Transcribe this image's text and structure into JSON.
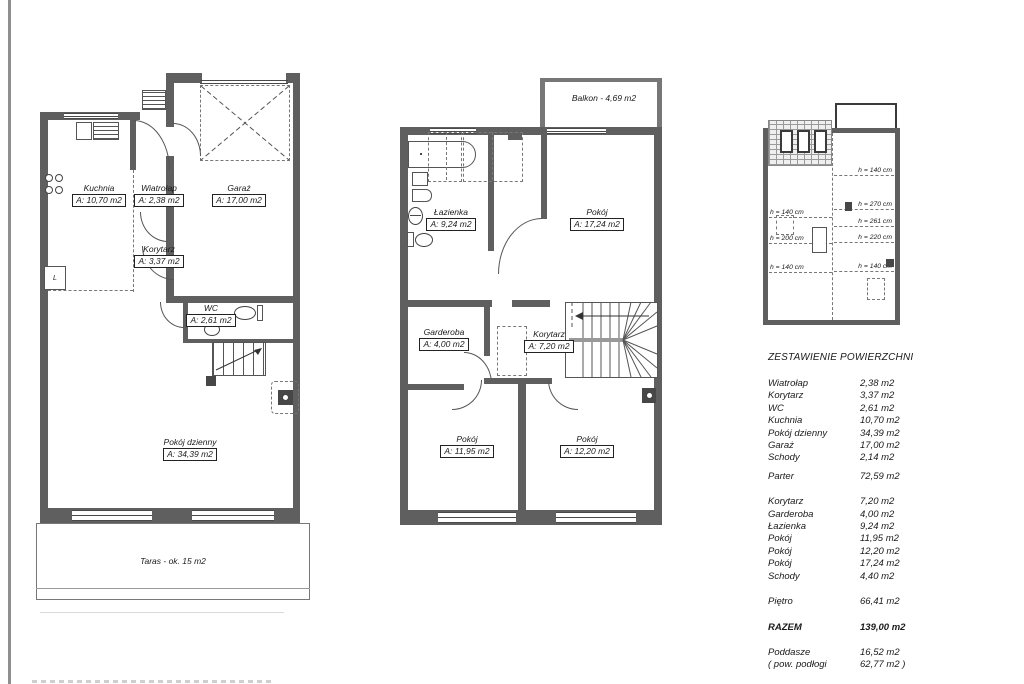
{
  "parter": {
    "rooms": [
      {
        "name": "Kuchnia",
        "area": "A: 10,70 m2"
      },
      {
        "name": "Wiatrołap",
        "area": "A: 2,38 m2"
      },
      {
        "name": "Garaż",
        "area": "A: 17,00 m2"
      },
      {
        "name": "Korytarz",
        "area": "A: 3,37 m2"
      },
      {
        "name": "WC",
        "area": "A: 2,61 m2"
      },
      {
        "name": "Pokój dzienny",
        "area": "A: 34,39 m2"
      }
    ],
    "taras_label": "Taras - ok. 15 m2",
    "appliance_label": "L"
  },
  "pietro": {
    "balkon_label": "Balkon - 4,69 m2",
    "rooms": [
      {
        "name": "Łazienka",
        "area": "A: 9,24 m2"
      },
      {
        "name": "Pokój",
        "area": "A: 17,24 m2"
      },
      {
        "name": "Garderoba",
        "area": "A: 4,00 m2"
      },
      {
        "name": "Korytarz",
        "area": "A: 7,20 m2"
      },
      {
        "name": "Pokój",
        "area": "A: 11,95 m2"
      },
      {
        "name": "Pokój",
        "area": "A: 12,20 m2"
      }
    ]
  },
  "poddasze": {
    "heights_right": [
      "h = 140 cm",
      "h = 270 cm",
      "h = 261 cm",
      "h = 220 cm",
      "h = 140 cm"
    ],
    "heights_left": [
      "h = 140 cm",
      "h = 200 cm",
      "h = 140 cm"
    ]
  },
  "table": {
    "title": "ZESTAWIENIE POWIERZCHNI",
    "rows": [
      {
        "label": "Wiatrołap",
        "value": "2,38 m2"
      },
      {
        "label": "Korytarz",
        "value": "3,37 m2"
      },
      {
        "label": "WC",
        "value": "2,61 m2"
      },
      {
        "label": "Kuchnia",
        "value": "10,70 m2"
      },
      {
        "label": "Pokój dzienny",
        "value": "34,39 m2"
      },
      {
        "label": "Garaż",
        "value": "17,00 m2"
      },
      {
        "label": "Schody",
        "value": "2,14 m2"
      },
      {
        "label": "Parter",
        "value": "72,59 m2"
      },
      {
        "label": "Korytarz",
        "value": "7,20 m2"
      },
      {
        "label": "Garderoba",
        "value": "4,00 m2"
      },
      {
        "label": "Łazienka",
        "value": "9,24 m2"
      },
      {
        "label": "Pokój",
        "value": "11,95 m2"
      },
      {
        "label": "Pokój",
        "value": "12,20 m2"
      },
      {
        "label": "Pokój",
        "value": "17,24 m2"
      },
      {
        "label": "Schody",
        "value": "4,40 m2"
      },
      {
        "label": "Piętro",
        "value": "66,41 m2"
      },
      {
        "label": "RAZEM",
        "value": "139,00 m2"
      },
      {
        "label": "Poddasze",
        "value": "16,52 m2"
      },
      {
        "label": "( pow. podłogi",
        "value": "62,77 m2 )"
      }
    ]
  }
}
